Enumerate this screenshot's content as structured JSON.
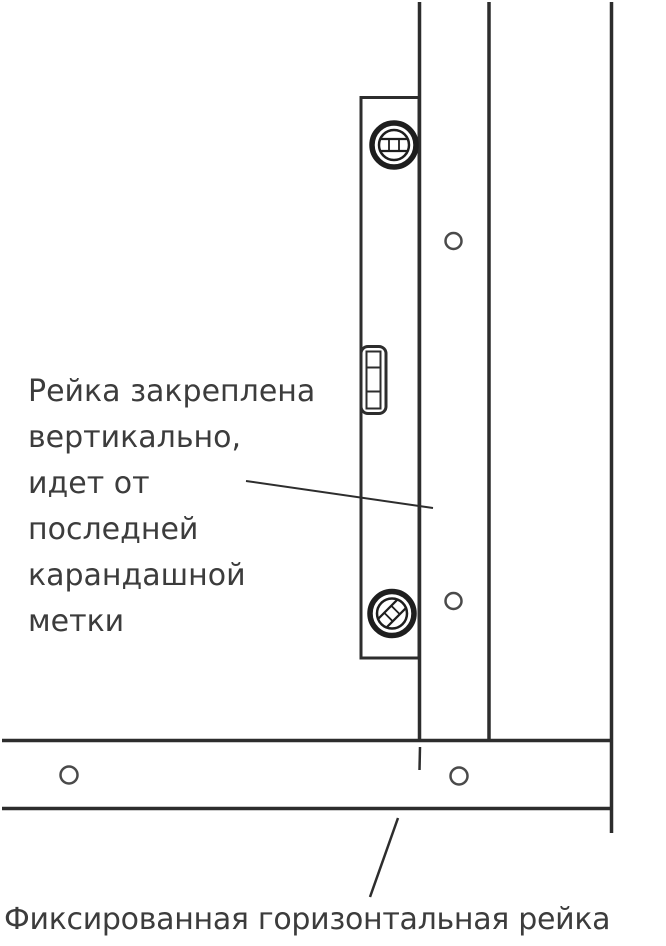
{
  "figure": {
    "type": "instructional-line-diagram",
    "subject": "spirit level held against vertical furring strip above fixed horizontal strip",
    "captions": {
      "left_lines": [
        "Рейка закреплена",
        "вертикально,",
        "идет от",
        "последней",
        "карандашной",
        "метки"
      ],
      "bottom": "Фиксированная горизонтальная рейка"
    },
    "icons": [
      "level-top-screw-icon",
      "level-bottom-screw-icon",
      "level-vial-icon",
      "screw-hole-icon",
      "pencil-mark-icon"
    ],
    "colors": {
      "background": "#ffffff",
      "line": "#2d2d2d",
      "hole_outline": "#4a4a4a",
      "text": "#3c3c3c"
    }
  }
}
